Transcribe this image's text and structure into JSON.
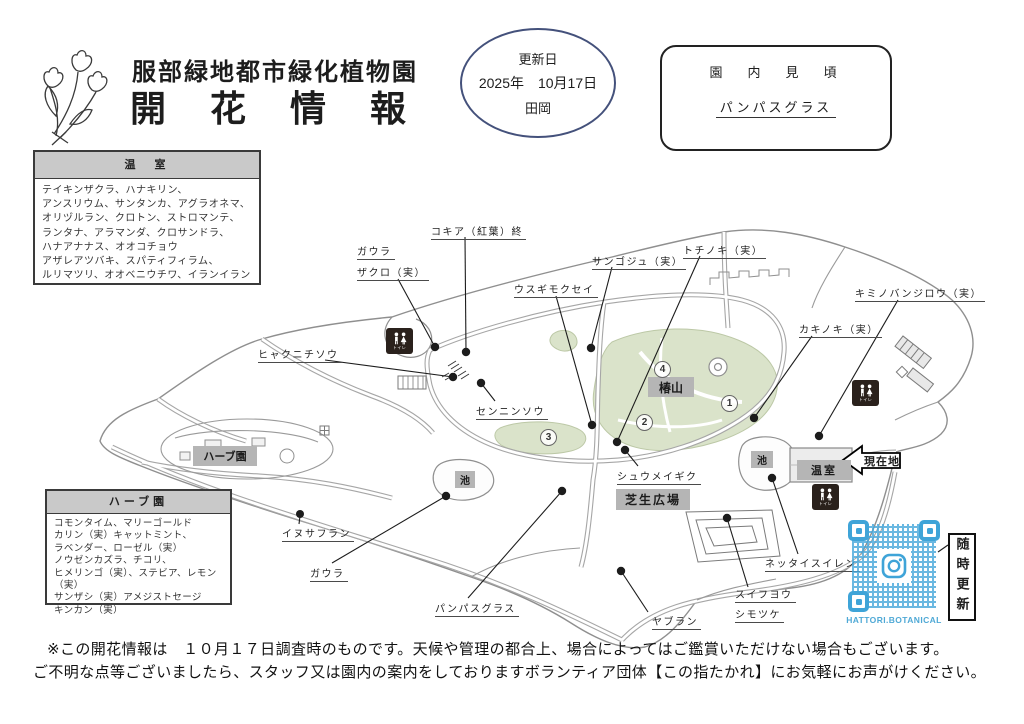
{
  "header": {
    "park_name": "服部緑地都市緑化植物園",
    "title": "開　花　情　報",
    "update": {
      "label": "更新日",
      "date": "2025年　10月17日",
      "staff": "田岡"
    },
    "highlight": {
      "title": "園　内　見　頃",
      "item": "パンパスグラス"
    }
  },
  "greenhouse": {
    "title": "温　室",
    "lines": [
      "テイキンザクラ、ハナキリン、",
      "アンスリウム、サンタンカ、アグラオネマ、",
      "オリヅルラン、クロトン、ストロマンテ、",
      "ランタナ、アラマンダ、クロサンドラ、",
      "ハナアナナス、オオコチョウ",
      "アザレアツバキ、スパティフィラム、",
      "ルリマツリ、オオベニウチワ、イランイラン"
    ]
  },
  "herb_garden": {
    "title": "ハーブ園",
    "lines": [
      "コモンタイム、マリーゴールド",
      "カリン（実）キャットミント、",
      "ラベンダー、ローゼル（実）",
      "ノウゼンカズラ、チコリ、",
      "ヒメリンゴ（実）、ステビア、レモン（実）",
      "サンザシ（実）アメジストセージ",
      "キンカン（実）"
    ]
  },
  "map": {
    "labels": [
      {
        "text": "ガウラ"
      },
      {
        "text": "ザクロ（実）"
      },
      {
        "text": "コキア（紅葉）終"
      },
      {
        "text": "ウスギモクセイ"
      },
      {
        "text": "サンゴジュ（実）"
      },
      {
        "text": "トチノキ（実）"
      },
      {
        "text": "キミノバンジロウ（実）"
      },
      {
        "text": "カキノキ（実）"
      },
      {
        "text": "ヒャクニチソウ"
      },
      {
        "text": "センニンソウ"
      },
      {
        "text": "シュウメイギク"
      },
      {
        "text": "イヌサフラン"
      },
      {
        "text": "ガウラ"
      },
      {
        "text": "パンパスグラス"
      },
      {
        "text": "ヤブラン"
      },
      {
        "text": "スイフヨウ"
      },
      {
        "text": "シモツケ"
      },
      {
        "text": "ネッタイスイレン"
      }
    ],
    "areas": {
      "tsubaki": "椿山",
      "lawn": "芝生広場",
      "herb": "ハーブ園",
      "greenhouse": "温室",
      "pond_right": "池",
      "pond_center": "池"
    },
    "numbers": [
      "1",
      "2",
      "3",
      "4"
    ],
    "current_location": "現在地",
    "qr_caption": "HATTORI.BOTANICAL",
    "update_badge": "随時更新"
  },
  "footer": {
    "line1": "※この開花情報は　１０月１７日調査時のものです。天候や管理の都合上、場合によってはご鑑賞いただけない場合もございます。",
    "line2": "ご不明な点等ございましたら、スタッフ又は園内の案内をしておりますボランティア団体【この指たかれ】にお気軽にお声がけください。"
  }
}
